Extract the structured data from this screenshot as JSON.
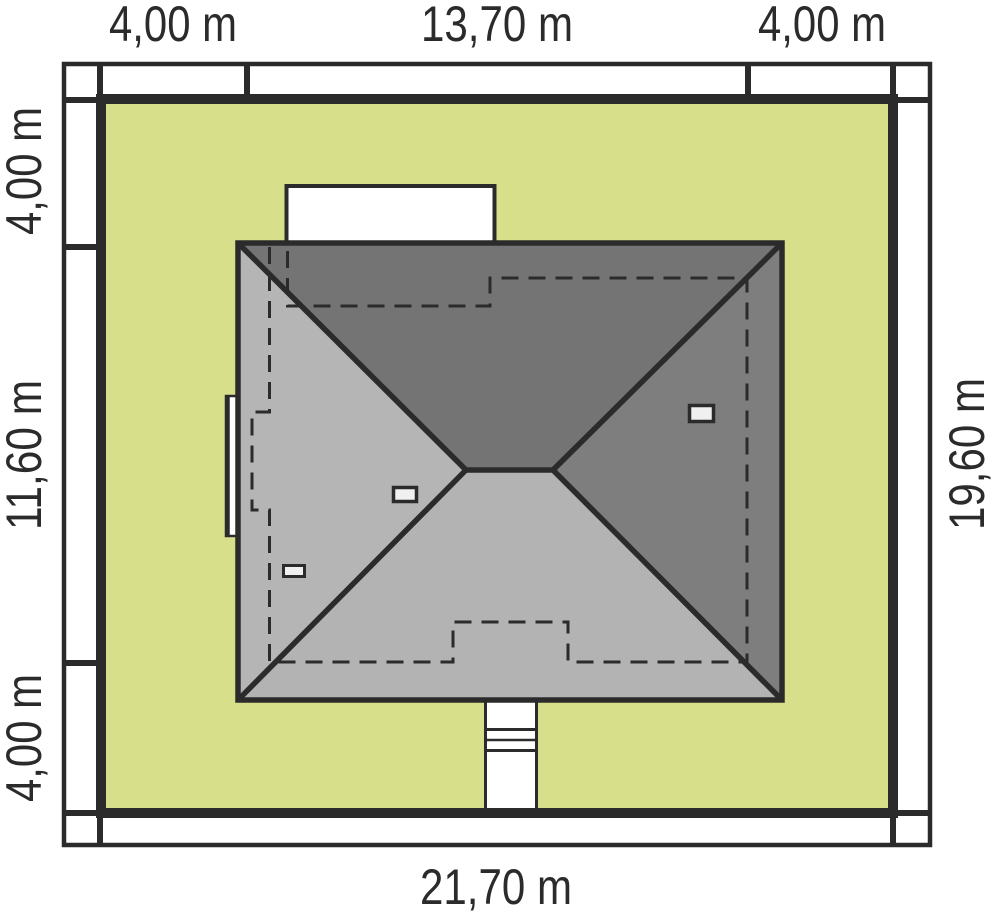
{
  "plan": {
    "type": "roof-site-plan",
    "dimension_labels": {
      "top": {
        "left": "4,00 m",
        "center": "13,70 m",
        "right": "4,00 m"
      },
      "left": {
        "top": "4,00 m",
        "middle": "11,60 m",
        "bottom": "4,00 m"
      },
      "right": {
        "middle": "19,60 m"
      },
      "bottom": {
        "center": "21,70 m"
      }
    },
    "colors": {
      "plot_fill": "#d8df8b",
      "line": "#2b2b2b",
      "roof_top_face": "#747474",
      "roof_right_face": "#7e7e7e",
      "roof_left_face": "#b5b5b5",
      "roof_bottom_face": "#b3b3b3",
      "terrace_fill": "#ffffff",
      "path_fill": "#ffffff",
      "vent_fill": "#f0f0f0",
      "text": "#2b2b2b"
    }
  }
}
